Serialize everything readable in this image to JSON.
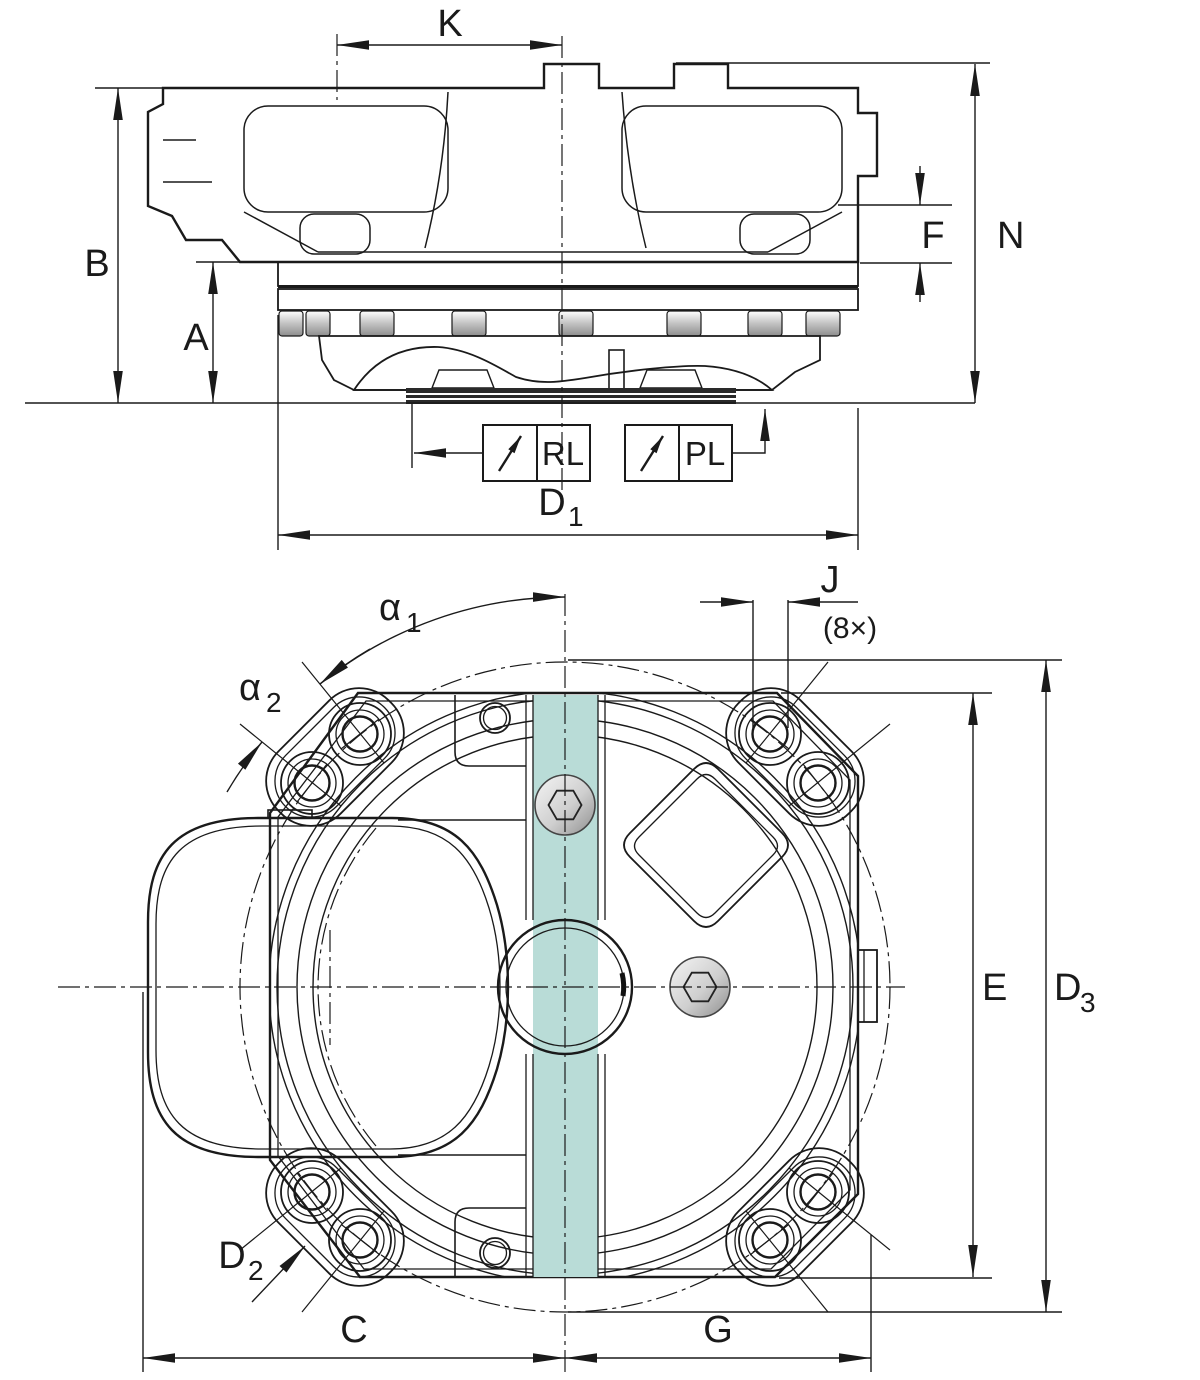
{
  "drawing": {
    "labels": {
      "K": "K",
      "B": "B",
      "A": "A",
      "F": "F",
      "N": "N",
      "D1_main": "D",
      "D1_sub": "1",
      "RL": "RL",
      "PL": "PL",
      "alpha1_main": "α",
      "alpha1_sub": "1",
      "alpha2_main": "α",
      "alpha2_sub": "2",
      "J": "J",
      "J_count": "(8×)",
      "E": "E",
      "D3_main": "D",
      "D3_sub": "3",
      "D2_main": "D",
      "D2_sub": "2",
      "C": "C",
      "G": "G"
    },
    "colors": {
      "body_teal": "#b9dcd7",
      "flange_green": "#d9efd9",
      "line": "#1a1a1a",
      "metal_light": "#f5f5f5",
      "metal_dark": "#8e8e8e",
      "background": "#ffffff"
    }
  }
}
